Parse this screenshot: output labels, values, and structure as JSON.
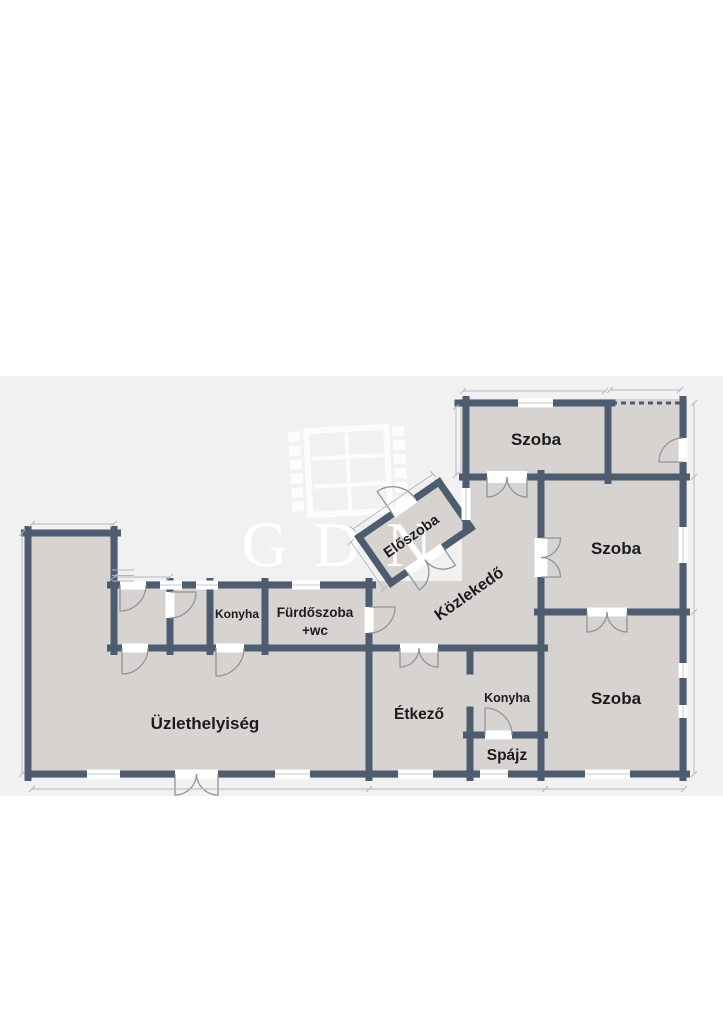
{
  "document": {
    "kind": "floor-plan",
    "language": "Hungarian"
  },
  "watermark": {
    "text": "GDN"
  },
  "colors": {
    "page_bg": "#ffffff",
    "plan_bg": "#f1f1f2",
    "floor": "#d7d3d1",
    "wall": "#4d5c6e",
    "label": "#1b1b1d",
    "opening": "#ffffff",
    "window_frame": "#c6c9ce",
    "door_arc": "#90959d",
    "dimension": "#b3b6bc",
    "watermark": "#ffffff"
  },
  "rooms": {
    "szoba_top": {
      "label": "Szoba"
    },
    "szoba_middle": {
      "label": "Szoba"
    },
    "szoba_bottom": {
      "label": "Szoba"
    },
    "kozlekedo": {
      "label": "Közlekedő"
    },
    "eloszoba": {
      "label": "Előszoba"
    },
    "konyha_small": {
      "label": "Konyha"
    },
    "furdoszoba": {
      "label": "Fürdőszoba",
      "label2": "+wc"
    },
    "uzlethelyiseg": {
      "label": "Üzlethelyiség"
    },
    "etkezo": {
      "label": "Étkező"
    },
    "konyha_bottom": {
      "label": "Konyha"
    },
    "spajz": {
      "label": "Spájz"
    }
  }
}
